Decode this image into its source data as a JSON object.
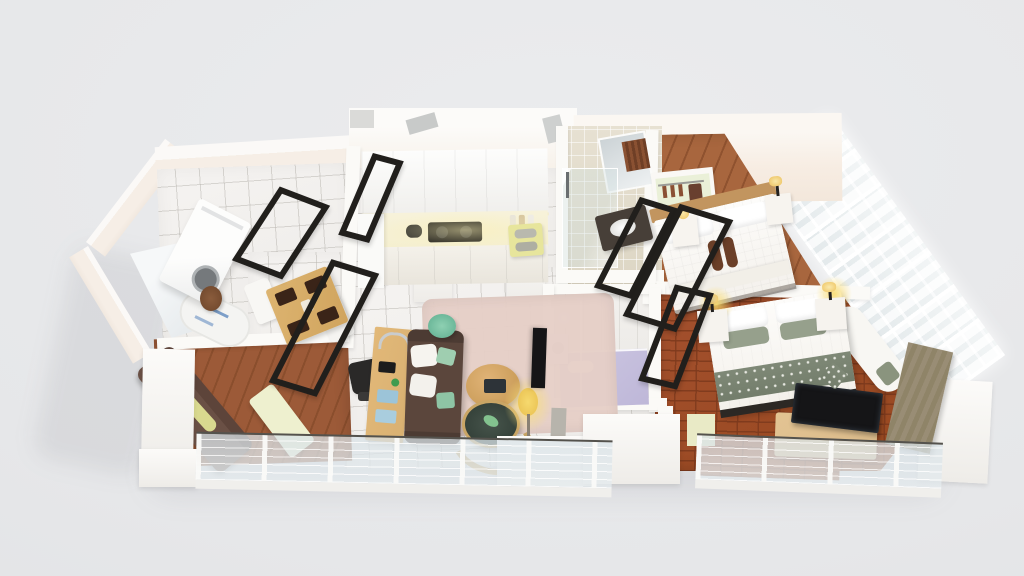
{
  "scene": {
    "description": "3D isometric rendering of a two-bedroom apartment floor plan on a plain light-gray backdrop; no visible text anywhere in the image",
    "view": "axonometric top-down, slight counter-clockwise tilt",
    "door_frame_count": 6
  },
  "palette": {
    "bg1": "#ebecee",
    "bg2": "#e6e7e9",
    "bg3": "#dfe0e3",
    "wall": "#faf8f5",
    "wallface": "#f5ece3",
    "black": "#211f1c",
    "tilefloor": "#f2f0ed",
    "plank": "#9c5a38",
    "plankline": "#8a4e2d",
    "plank2": "#a8663e",
    "brick": "#a3502e",
    "sofa": "#5b463c",
    "densofa": "#6a5045",
    "wood": "#d9b172",
    "woodtable": "#d0a45e",
    "rug": "#e6cfc7",
    "sage": "#9fceb0",
    "sagegray": "#96a08c",
    "paleyellow": "#eef0cf",
    "bolsteryellow": "#d9d98f",
    "accent": "#e7e59c",
    "lavender": "#beb7d8",
    "beige": "#e7e1d2",
    "headboard": "#c2955f",
    "bolster": "#6b3f28",
    "floral": "#7f8977",
    "tv": "#151517",
    "cabwood": "#d9b989",
    "glow": "#f8df7e",
    "railbase": "#f0efec",
    "counter": "#f5efcf",
    "mirror": "#ccd3d6",
    "pillar": "#8f8468"
  },
  "rooms": [
    {
      "name": "laundry-room",
      "floor": "white tile",
      "furniture": [
        "washing-machine",
        "laundry-basket",
        "laundry-rug",
        "left-wall-window"
      ]
    },
    {
      "name": "dining-hall",
      "floor": "white tile",
      "furniture": [
        "wood-dining-table",
        "4 dark placemats",
        "white-chair-left",
        "white-chair-right"
      ]
    },
    {
      "name": "kitchen",
      "floor": "white tile",
      "furniture": [
        "upper-cabinets",
        "counter-with-cooktop",
        "under-cabinet-lighting",
        "tall-unit",
        "yellow-green-accent-cabinet"
      ]
    },
    {
      "name": "bathroom-1",
      "floor": "beige tile",
      "furniture": [
        "glass-shower",
        "dark-vanity-with-sink",
        "mirror",
        "wood-slat-accent"
      ]
    },
    {
      "name": "bedroom-1",
      "floor": "terracotta planks",
      "furniture": [
        "double-bed-wood-headboard",
        "2 white pillows",
        "2 brown bolster-rolls",
        "nightstand-left-with-lamp",
        "nightstand-right-with-lamp",
        "open-wardrobe-with-hangers"
      ]
    },
    {
      "name": "bathroom-2",
      "floor": "white + lavender shower zone",
      "furniture": [
        "toilet",
        "small-sink",
        "glass-shower-screen",
        "towel"
      ]
    },
    {
      "name": "living-room",
      "floor": "white tile + pink rug",
      "furniture": [
        "brown-sofa with white and seafoam cushions",
        "wood-desk with lamp, phone, blue mats, green bottle",
        "black-office-chair",
        "green-stool",
        "round-coffee-table with tray",
        "round-nook-table",
        "rattan-chair with dark-green seat",
        "glowing-floor-lamp",
        "wall-tv"
      ]
    },
    {
      "name": "den",
      "floor": "terracotta planks",
      "furniture": [
        "brown-sofa with yellow bolster",
        "pale-yellow-bench",
        "pale-yellow-cushion"
      ]
    },
    {
      "name": "bedroom-2-master",
      "floor": "terracotta brick",
      "furniture": [
        "double-bed with floral throw and sage pillows",
        "nightstand-left-with-glowing-lamp",
        "nightstand-right-with-glowing-lamp",
        "tv-on-wood-cabinet",
        "white-chaise-by-window",
        "floral-cushion"
      ]
    }
  ],
  "exterior": {
    "window_wall": "floor-to-ceiling glazing with white mullions and sheer curtains along the right side",
    "balconies": [
      "long glass balustrade along lower left/center",
      "glass balustrade at master-bedroom balcony lower right"
    ],
    "wood_pillar": "wood-grain wall fin at lower-right corner"
  }
}
